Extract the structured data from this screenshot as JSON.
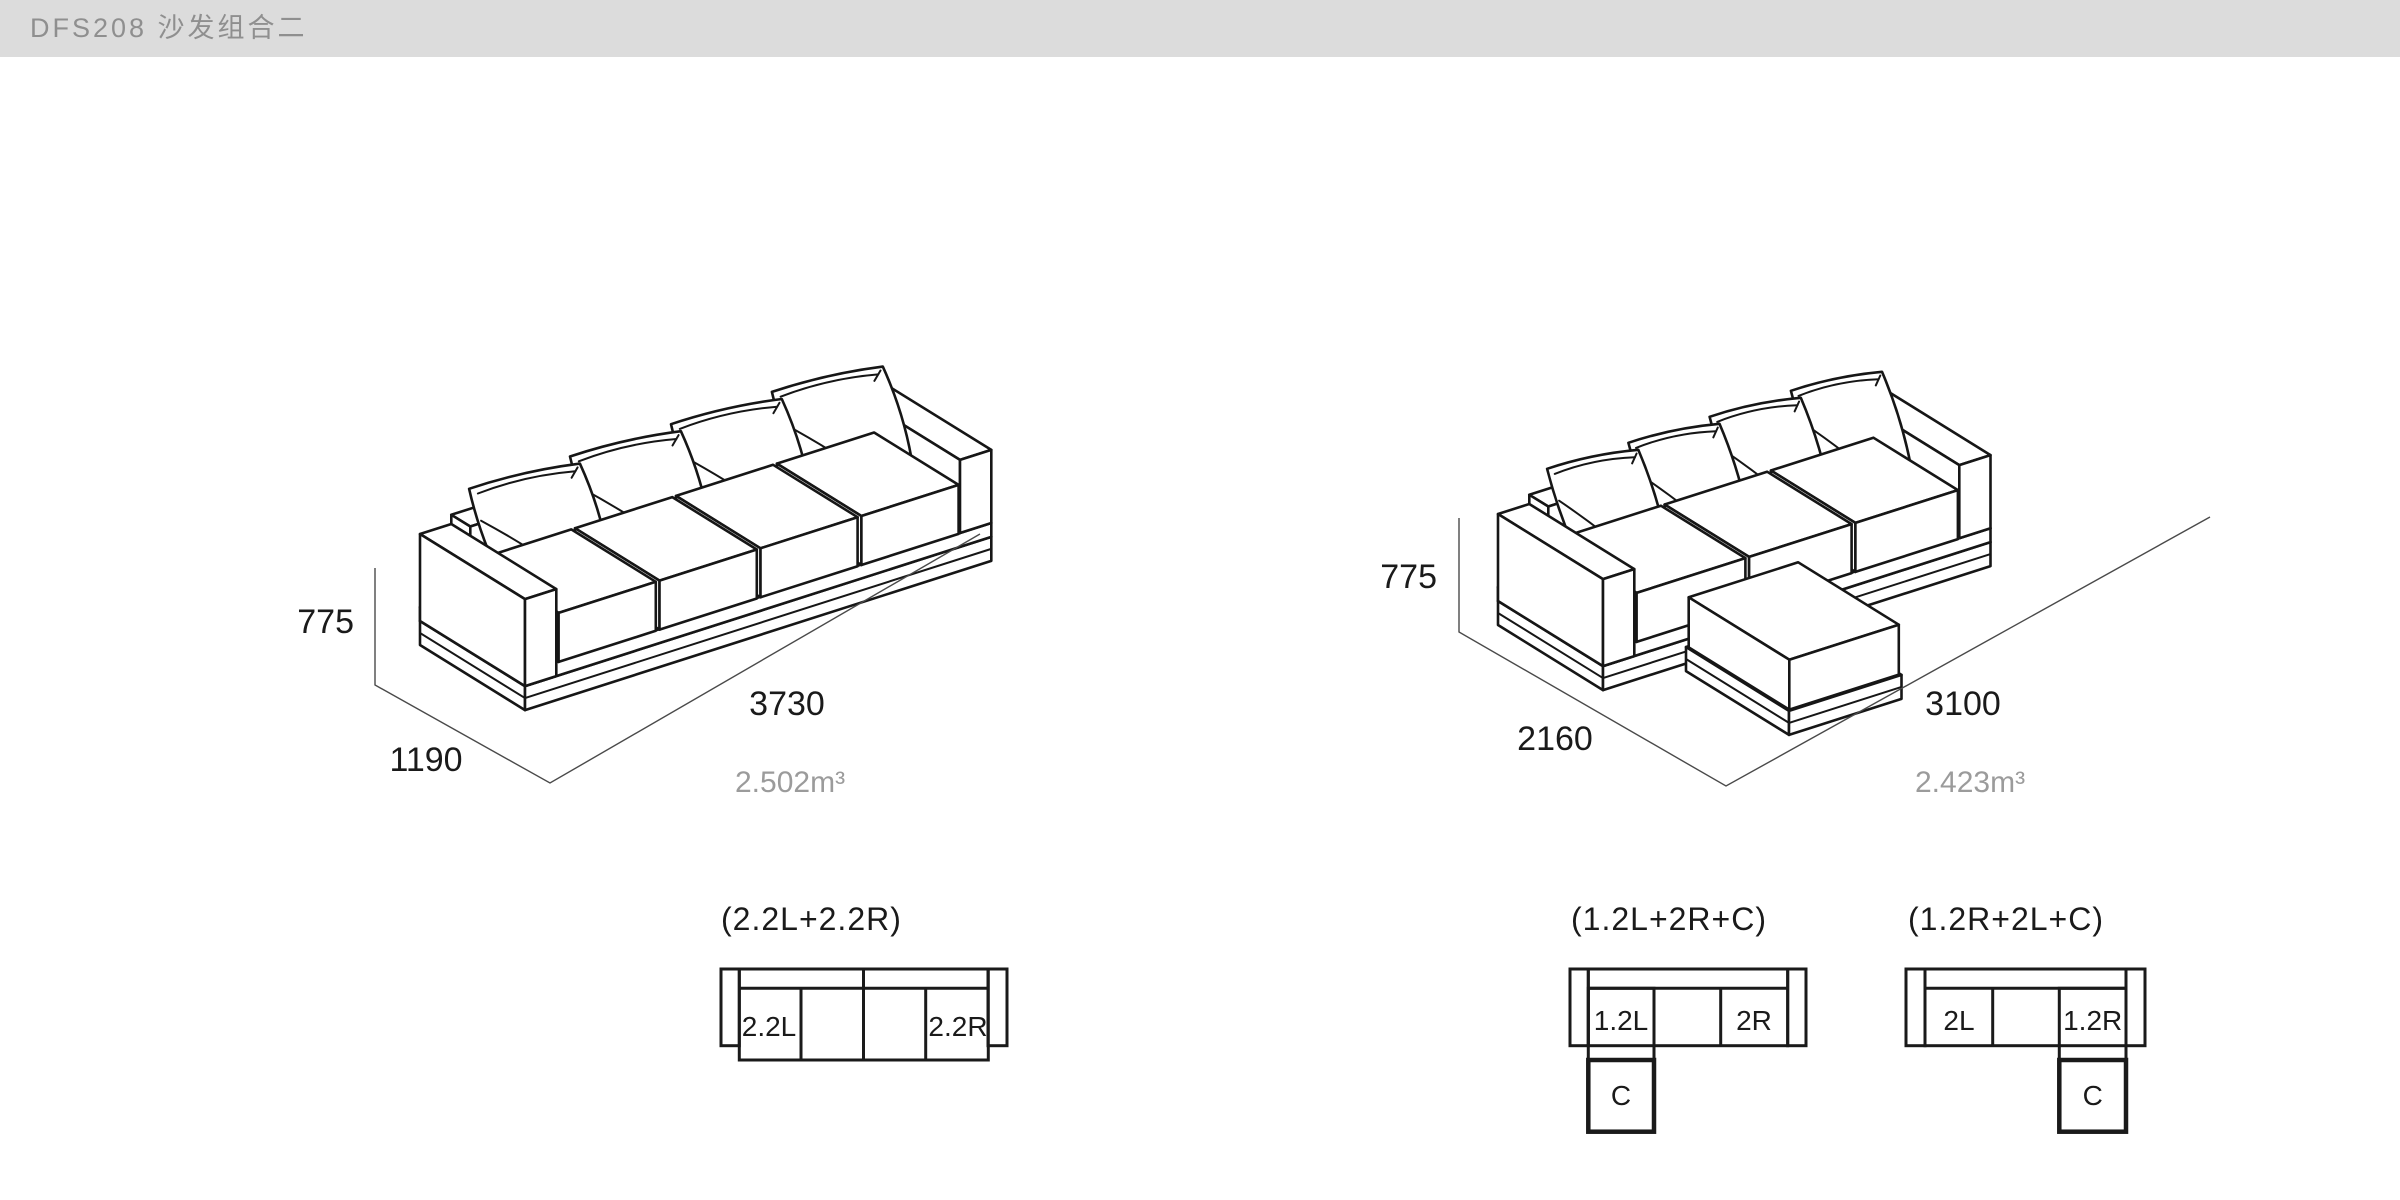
{
  "header": {
    "title": "DFS208 沙发组合二"
  },
  "figures": [
    {
      "name": "straight-sofa",
      "height": "775",
      "depth": "1190",
      "length": "3730",
      "volume": "2.502m³"
    },
    {
      "name": "chaise-sofa",
      "height": "775",
      "depth": "2160",
      "length": "3100",
      "volume": "2.423m³"
    }
  ],
  "plans": [
    {
      "title": "(2.2L+2.2R)",
      "cells": [
        "2.2L",
        "2.2R"
      ]
    },
    {
      "title": "(1.2L+2R+C)",
      "cells": [
        "1.2L",
        "2R",
        "C"
      ]
    },
    {
      "title": "(1.2R+2L+C)",
      "cells": [
        "2L",
        "1.2R",
        "C"
      ]
    }
  ],
  "colors": {
    "header_bg": "#dcdcdc",
    "header_text": "#8f8f8f",
    "art_line": "#161616",
    "dim_line": "#4a4a4a",
    "text": "#1a1a1a",
    "muted_text": "#9b9b9b",
    "background": "#ffffff"
  }
}
